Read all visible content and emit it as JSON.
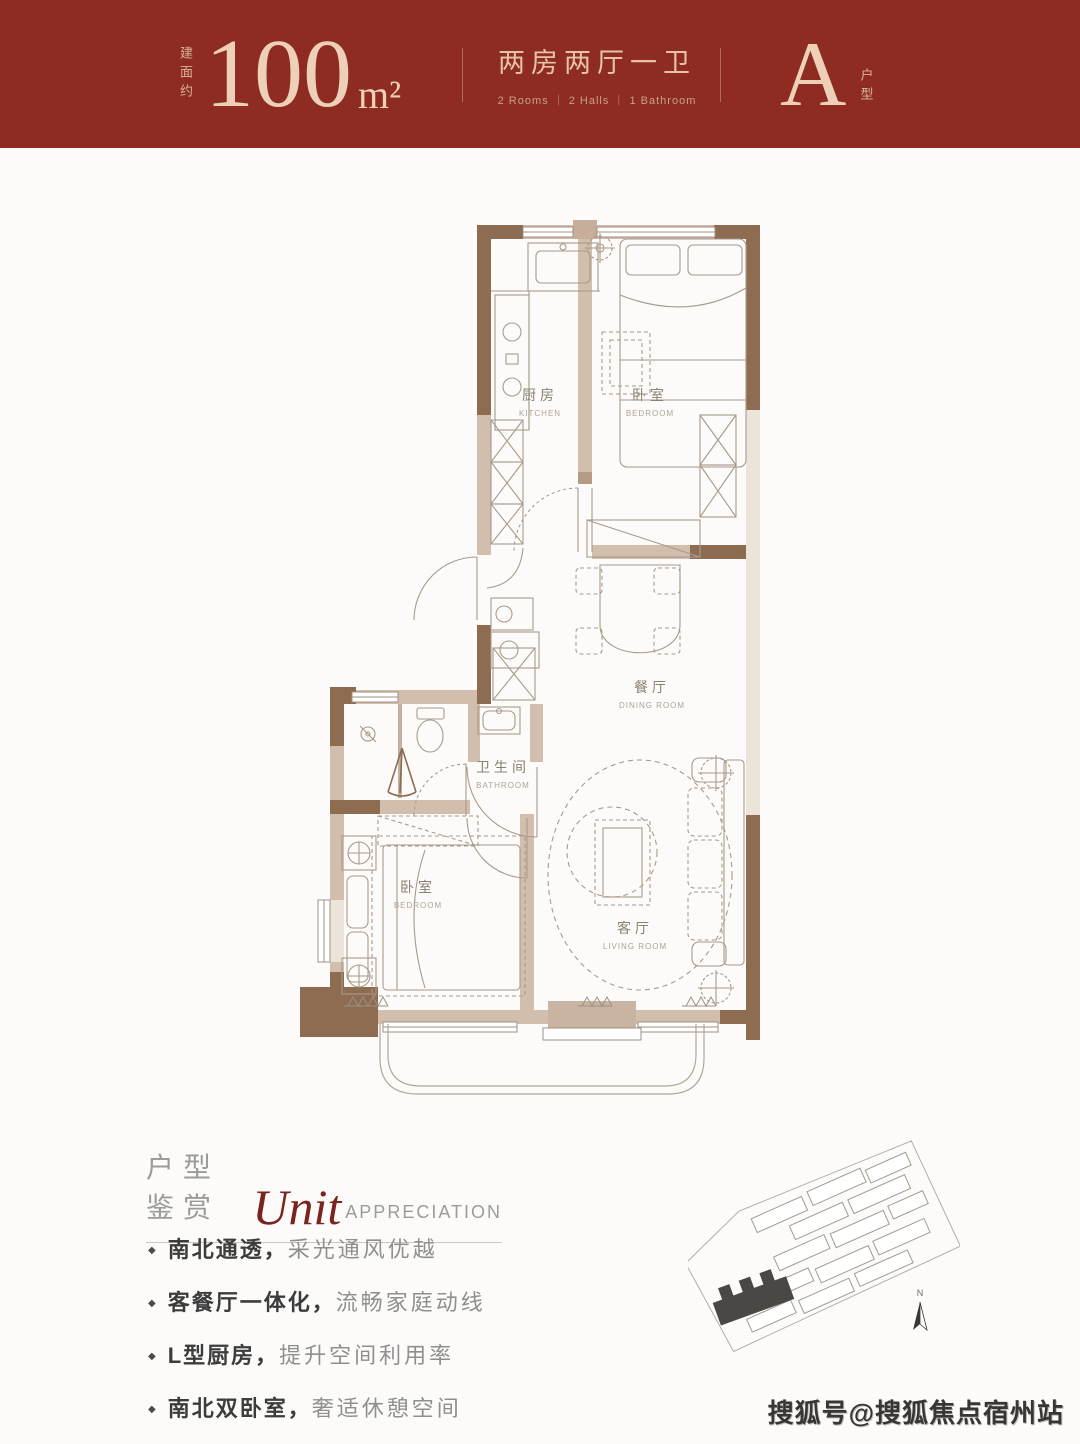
{
  "header": {
    "area_label_vertical": "建面约",
    "area_value": "100",
    "area_unit": "m²",
    "layout_cn": "两房两厅一卫",
    "layout_en": "2 Rooms ｜ 2 Halls ｜ 1 Bathroom",
    "unit_letter": "A",
    "unit_label_vertical": "户型",
    "bg_top": "#17100d",
    "bg_bottom": "#8e2b22",
    "text_color": "#ead0b6"
  },
  "floorplan": {
    "wall_dark": "#8d6c52",
    "wall_light": "#d2bead",
    "window_fill": "#ece4d9",
    "line_color": "#a89a8b",
    "rooms": [
      {
        "cn": "厨房",
        "en": "KITCHEN"
      },
      {
        "cn": "卧室",
        "en": "BEDROOM"
      },
      {
        "cn": "餐厅",
        "en": "DINING ROOM"
      },
      {
        "cn": "卫生间",
        "en": "BATHROOM"
      },
      {
        "cn": "卧室",
        "en": "BEDROOM"
      },
      {
        "cn": "客厅",
        "en": "LIVING ROOM"
      }
    ]
  },
  "section": {
    "title_cn": "户型鉴赏",
    "title_script": "Unit",
    "title_en": "APPRECIATION",
    "features": [
      {
        "bold": "南北通透，",
        "rest": "采光通风优越"
      },
      {
        "bold": "客餐厅一体化，",
        "rest": "流畅家庭动线"
      },
      {
        "bold": "L型厨房，",
        "rest": "提升空间利用率"
      },
      {
        "bold": "南北双卧室，",
        "rest": "奢适休憩空间"
      }
    ]
  },
  "siteplan": {
    "north_label": "N"
  },
  "watermark": "搜狐号@搜狐焦点宿州站"
}
